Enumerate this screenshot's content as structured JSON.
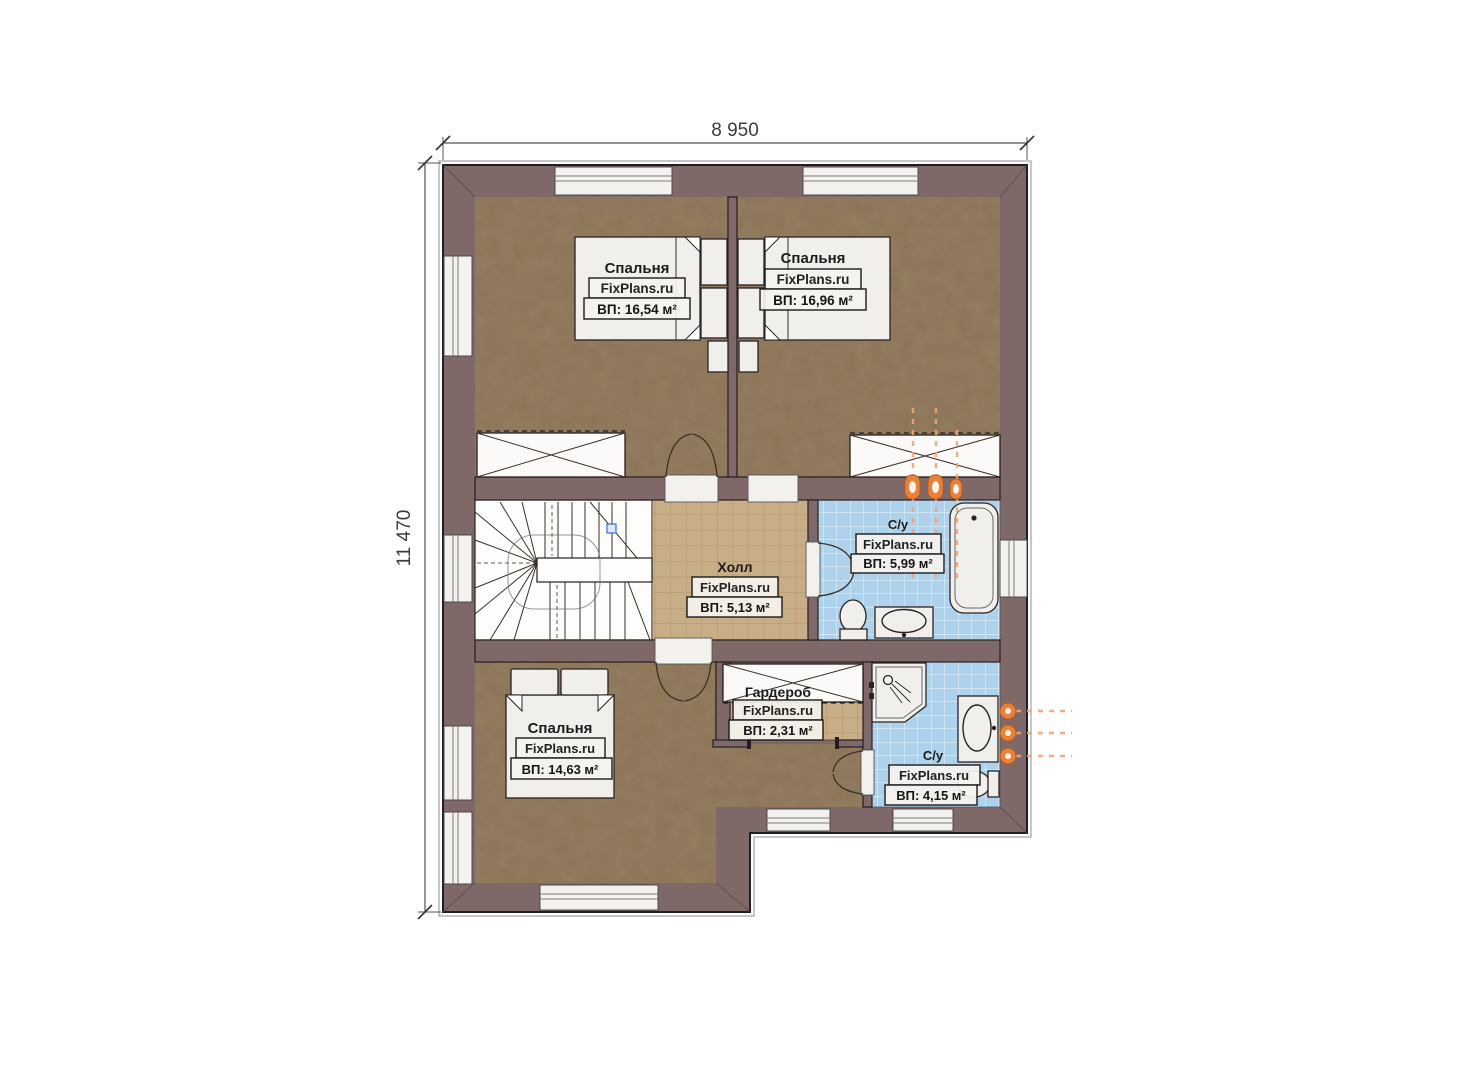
{
  "plan_type": "floor-plan",
  "watermark": "FixPlans.ru",
  "dimensions": {
    "width_label": "8 950",
    "height_label": "11 470"
  },
  "rooms": [
    {
      "id": "bedroom-top-left",
      "name": "Спальня",
      "area": "ВП: 16,54 м²"
    },
    {
      "id": "bedroom-top-right",
      "name": "Спальня",
      "area": "ВП: 16,96 м²"
    },
    {
      "id": "hall",
      "name": "Холл",
      "area": "ВП: 5,13 м²"
    },
    {
      "id": "bathroom-top",
      "name": "С/у",
      "area": "ВП: 5,99 м²"
    },
    {
      "id": "bedroom-bottom",
      "name": "Спальня",
      "area": "ВП: 14,63 м²"
    },
    {
      "id": "wardrobe",
      "name": "Гардероб",
      "area": "ВП: 2,31 м²"
    },
    {
      "id": "bathroom-bottom",
      "name": "С/у",
      "area": "ВП: 4,15 м²"
    }
  ],
  "colors": {
    "wall": "#7e6868",
    "bedroom_floor": "#8b7356",
    "hall_floor": "#c8ae86",
    "bath_floor": "#aed2ec",
    "radiator": "#e9813a",
    "background": "#ffffff"
  }
}
